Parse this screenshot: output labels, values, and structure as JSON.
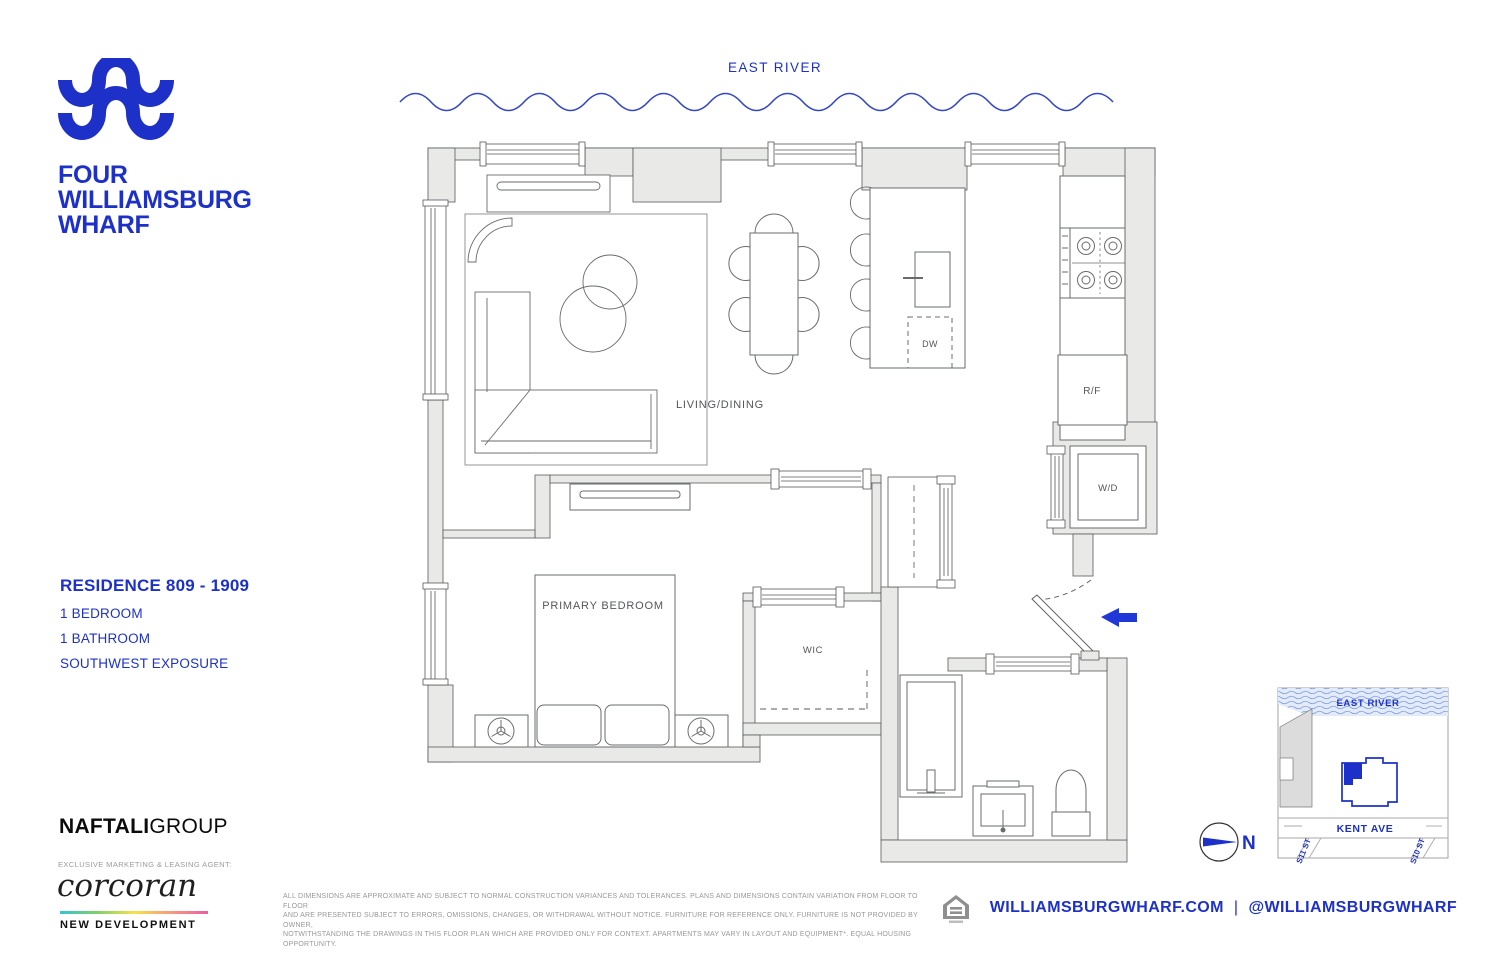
{
  "brand": {
    "logo_lines": [
      "FOUR",
      "WILLIAMSBURG",
      "WHARF"
    ],
    "accent_blue": "#1d31c9"
  },
  "river": {
    "label": "EAST RIVER"
  },
  "plan": {
    "labels": {
      "living": "LIVING/DINING",
      "bedroom": "PRIMARY BEDROOM",
      "wic": "WIC",
      "dw": "DW",
      "rf": "R/F",
      "wd": "W/D"
    },
    "wall_color": "#e9e9e8",
    "line_color": "#58595b"
  },
  "residence": {
    "title": "RESIDENCE 809 - 1909",
    "features": [
      "1 BEDROOM",
      "1 BATHROOM",
      "SOUTHWEST EXPOSURE"
    ]
  },
  "developer": {
    "name_bold": "NAFTALI",
    "name_light": "GROUP",
    "agent_line": "EXCLUSIVE MARKETING & LEASING AGENT:",
    "agent_name": "corcoran",
    "agent_sub": "NEW DEVELOPMENT"
  },
  "disclaimer": {
    "line1": "ALL DIMENSIONS ARE APPROXIMATE AND SUBJECT TO NORMAL CONSTRUCTION VARIANCES AND TOLERANCES. PLANS AND DIMENSIONS CONTAIN VARIATION FROM FLOOR TO FLOOR",
    "line2": "AND ARE PRESENTED SUBJECT TO ERRORS, OMISSIONS, CHANGES, OR WITHDRAWAL WITHOUT NOTICE. FURNITURE FOR REFERENCE ONLY. FURNITURE IS NOT PROVIDED BY OWNER,",
    "line3": "NOTWITHSTANDING THE DRAWINGS IN THIS FLOOR PLAN WHICH ARE PROVIDED ONLY FOR CONTEXT.  APARTMENTS MAY VARY IN LAYOUT AND EQUIPMENT*. EQUAL HOUSING OPPORTUNITY."
  },
  "footer": {
    "website": "WILLIAMSBURGWHARF.COM",
    "separator": "|",
    "social": "@WILLIAMSBURGWHARF"
  },
  "map": {
    "river_label": "EAST RIVER",
    "street_main": "KENT AVE",
    "street_cross1": "S11 ST",
    "street_cross2": "S10 ST",
    "compass_n": "N"
  }
}
